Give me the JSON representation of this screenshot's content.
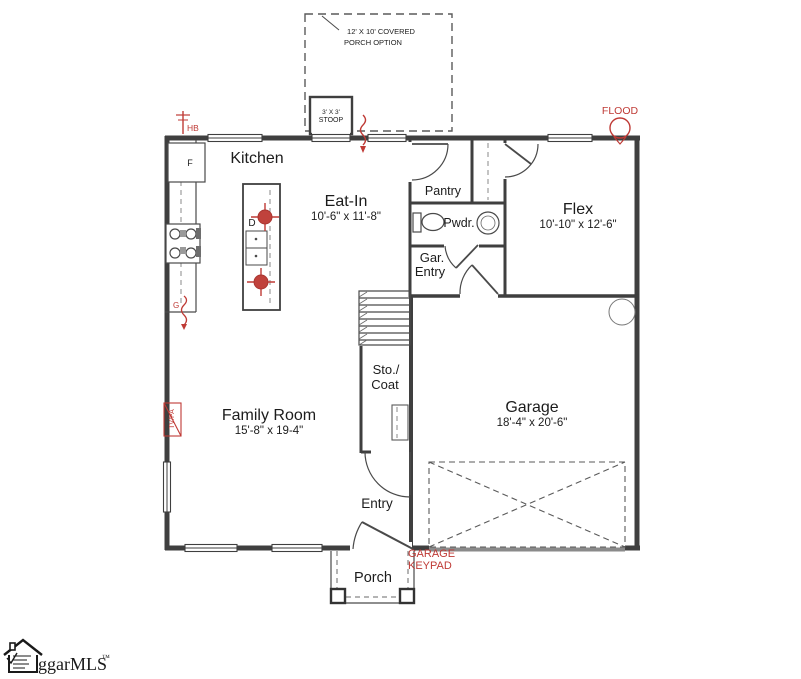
{
  "colors": {
    "wall": "#3f3f3f",
    "annotation_red": "#bf3a35",
    "garage_door_gray": "#8a8a8a",
    "background": "#ffffff"
  },
  "options": {
    "covered_porch": {
      "line1": "12' X 10' COVERED",
      "line2": "PORCH OPTION"
    },
    "stoop": {
      "line1": "3' X 3'",
      "line2": "STOOP"
    }
  },
  "rooms": {
    "kitchen": {
      "name": "Kitchen"
    },
    "eat_in": {
      "name": "Eat-In",
      "dims": "10'-6\" x 11'-8\""
    },
    "pantry": {
      "name": "Pantry"
    },
    "powder": {
      "name": "Pwdr."
    },
    "flex": {
      "name": "Flex",
      "dims": "10'-10\" x 12'-6\""
    },
    "garage_entry": {
      "line1": "Gar.",
      "line2": "Entry"
    },
    "storage_coat": {
      "line1": "Sto./",
      "line2": "Coat"
    },
    "family_room": {
      "name": "Family Room",
      "dims": "15'-8\" x 19-4\""
    },
    "garage": {
      "name": "Garage",
      "dims": "18'-4\" x 20'-6\""
    },
    "entry": {
      "name": "Entry"
    },
    "porch": {
      "name": "Porch"
    }
  },
  "annotations": {
    "hose_bib": "HB",
    "flood_light": "FLOOD",
    "garage_keypad": {
      "line1": "GARAGE",
      "line2": "KEYPAD"
    },
    "tv_phone": "TV/PA",
    "refrigerator": "F",
    "dishwasher": "D",
    "gas": "G"
  },
  "logo": {
    "text": "ggarMLS",
    "tm": "™"
  }
}
